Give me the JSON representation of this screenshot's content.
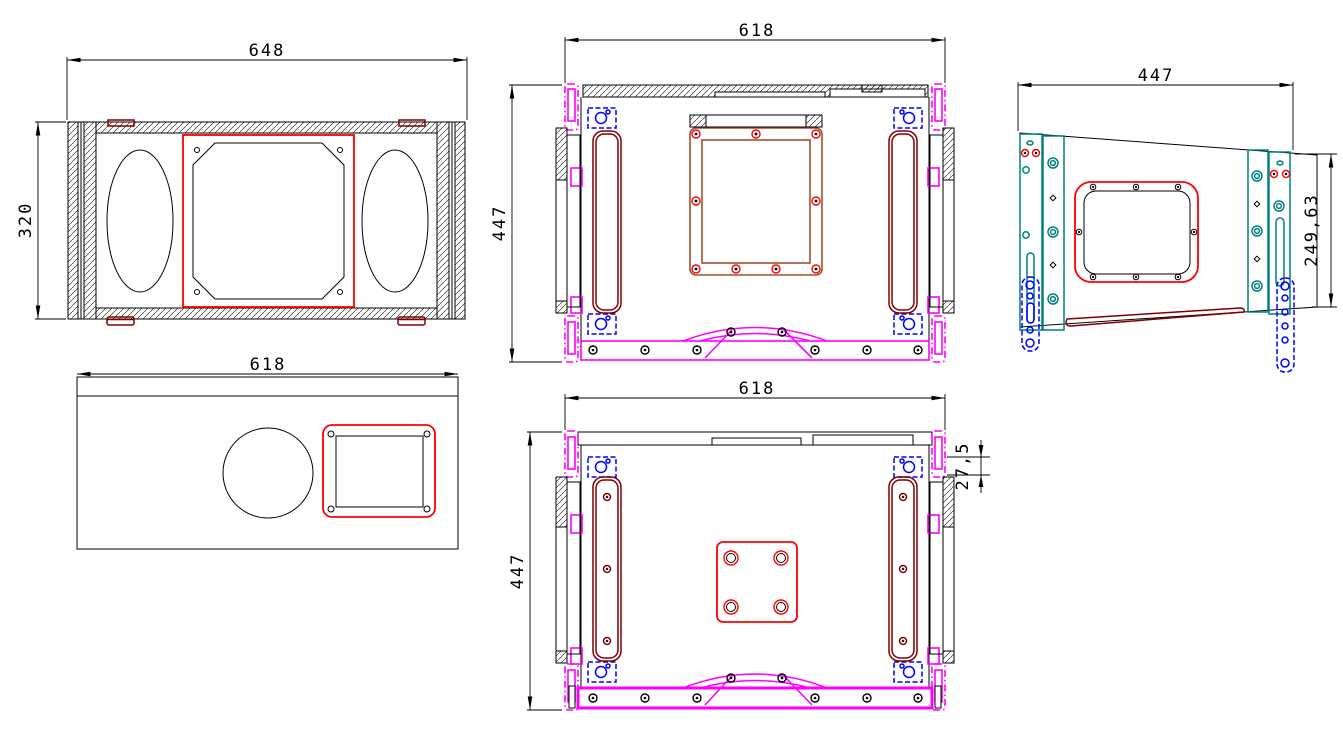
{
  "drawing": {
    "type": "cad-technical-drawing",
    "subject": "loudspeaker-cabinet-multiview",
    "views": {
      "front": {
        "label": "front-view",
        "width_dim": "648",
        "height_dim": "320"
      },
      "top": {
        "label": "top-view",
        "width_dim": "618",
        "depth_dim": "447"
      },
      "side": {
        "label": "side-view",
        "width_dim": "447",
        "height_dim": "249,63"
      },
      "panel": {
        "label": "bottom-panel-view",
        "width_dim": "618"
      },
      "bottom": {
        "label": "bottom-view",
        "width_dim": "618",
        "depth_dim": "447",
        "wall_dim": "27,5"
      }
    },
    "colors": {
      "outline": "#000000",
      "cutout_marking": "#ff0000",
      "rail_highlight": "#ff00ff",
      "bracket": "#0000ff",
      "rigging_rail": "#008080",
      "handle": "#800000",
      "frame": "#a0522d",
      "background": "#ffffff"
    }
  }
}
